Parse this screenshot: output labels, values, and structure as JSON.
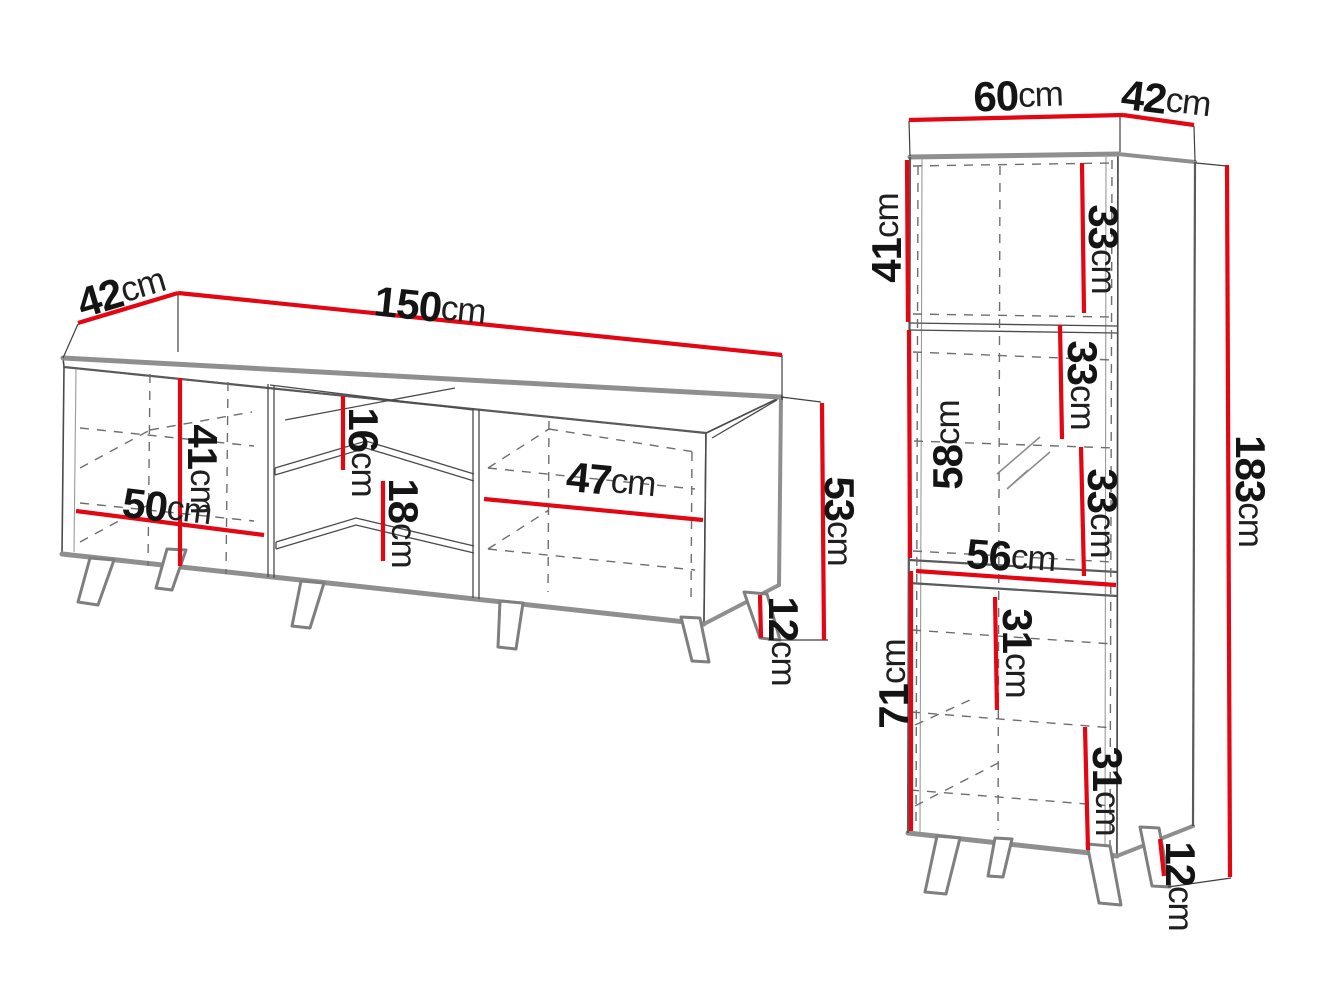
{
  "title": "Furniture dimensions technical drawing",
  "colors": {
    "dimension_red": "#e30613",
    "edge_gray": "#8f8f8f",
    "line_dark": "#4a4a4a",
    "text": "#141414",
    "background": "#ffffff"
  },
  "tv_stand": {
    "depth": {
      "value": "42",
      "unit": "cm"
    },
    "width": {
      "value": "150",
      "unit": "cm"
    },
    "door_height": {
      "value": "41",
      "unit": "cm"
    },
    "door_width": {
      "value": "50",
      "unit": "cm"
    },
    "upper_shelf_gap": {
      "value": "16",
      "unit": "cm"
    },
    "lower_shelf_gap": {
      "value": "18",
      "unit": "cm"
    },
    "right_compartment_width": {
      "value": "47",
      "unit": "cm"
    },
    "body_height": {
      "value": "53",
      "unit": "cm"
    },
    "leg_height": {
      "value": "12",
      "unit": "cm"
    }
  },
  "cabinet": {
    "width": {
      "value": "60",
      "unit": "cm"
    },
    "depth": {
      "value": "42",
      "unit": "cm"
    },
    "top_door_height": {
      "value": "41",
      "unit": "cm"
    },
    "top_shelf_space": {
      "value": "33",
      "unit": "cm"
    },
    "middle_door_height": {
      "value": "58",
      "unit": "cm"
    },
    "middle_shelf_space_upper": {
      "value": "33",
      "unit": "cm"
    },
    "middle_shelf_space_lower": {
      "value": "33",
      "unit": "cm"
    },
    "interior_width": {
      "value": "56",
      "unit": "cm"
    },
    "bottom_door_height": {
      "value": "71",
      "unit": "cm"
    },
    "bottom_shelf_space_upper": {
      "value": "31",
      "unit": "cm"
    },
    "bottom_shelf_space_lower": {
      "value": "31",
      "unit": "cm"
    },
    "total_height": {
      "value": "183",
      "unit": "cm"
    },
    "leg_height": {
      "value": "12",
      "unit": "cm"
    }
  }
}
